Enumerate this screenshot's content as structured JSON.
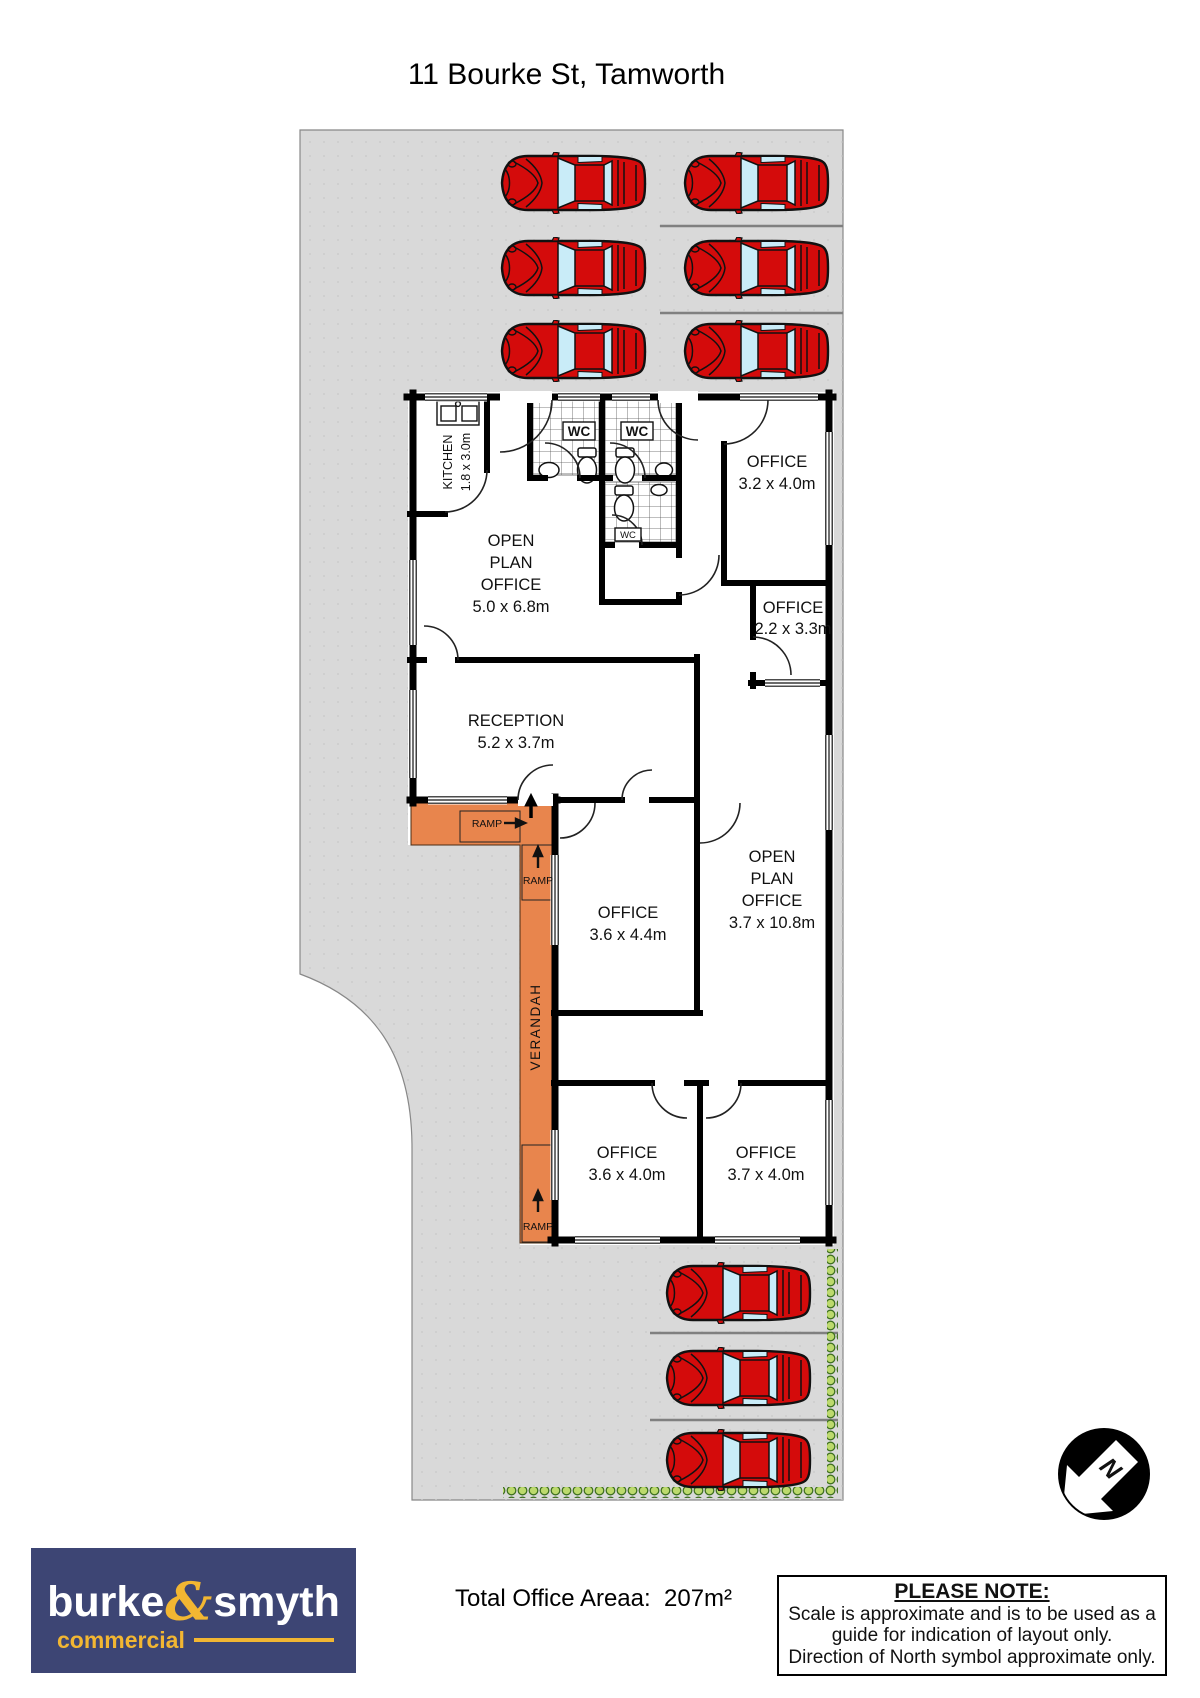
{
  "title": "11 Bourke St, Tamworth",
  "site": {
    "parking_spaces_top": 6,
    "parking_spaces_bottom": 3
  },
  "rooms": {
    "kitchen": {
      "name": "KITCHEN",
      "dims": "1.8 x 3.0m"
    },
    "wc": {
      "label": "WC"
    },
    "office_top_right": {
      "name": "OFFICE",
      "dims": "3.2 x 4.0m"
    },
    "open_plan_front": {
      "lines": [
        "OPEN",
        "PLAN",
        "OFFICE"
      ],
      "dims": "5.0 x 6.8m"
    },
    "office_side": {
      "name": "OFFICE",
      "dims": "2.2 x 3.3m"
    },
    "reception": {
      "name": "RECEPTION",
      "dims": "5.2 x 3.7m"
    },
    "open_plan_rear": {
      "lines": [
        "OPEN",
        "PLAN",
        "OFFICE"
      ],
      "dims": "3.7 x 10.8m"
    },
    "office_middle": {
      "name": "OFFICE",
      "dims": "3.6 x 4.4m"
    },
    "office_rear_left": {
      "name": "OFFICE",
      "dims": "3.6 x 4.0m"
    },
    "office_rear_right": {
      "name": "OFFICE",
      "dims": "3.7 x 4.0m"
    },
    "verandah": {
      "name": "VERANDAH"
    },
    "ramp": {
      "label": "RAMP"
    }
  },
  "north": {
    "label": "N"
  },
  "logo": {
    "word1": "burke",
    "ampersand": "&",
    "word2": "smyth",
    "tagline": "commercial"
  },
  "footer": {
    "total_area_label": "Total Office Areaa:  207m²",
    "note_title": "PLEASE NOTE:",
    "note_lines": [
      "Scale is approximate and is to be used as a",
      "guide for indication of layout only.",
      "Direction of North symbol approximate only."
    ]
  },
  "colors": {
    "site_grey": "#d9d9d9",
    "verandah_orange": "#e8854d",
    "car_red": "#d40b0b",
    "car_glass": "#c9ecf8",
    "hedge_green": "#bcd96d",
    "hedge_outline": "#3f7021",
    "logo_navy": "#3d4574",
    "logo_gold": "#f2b632"
  }
}
